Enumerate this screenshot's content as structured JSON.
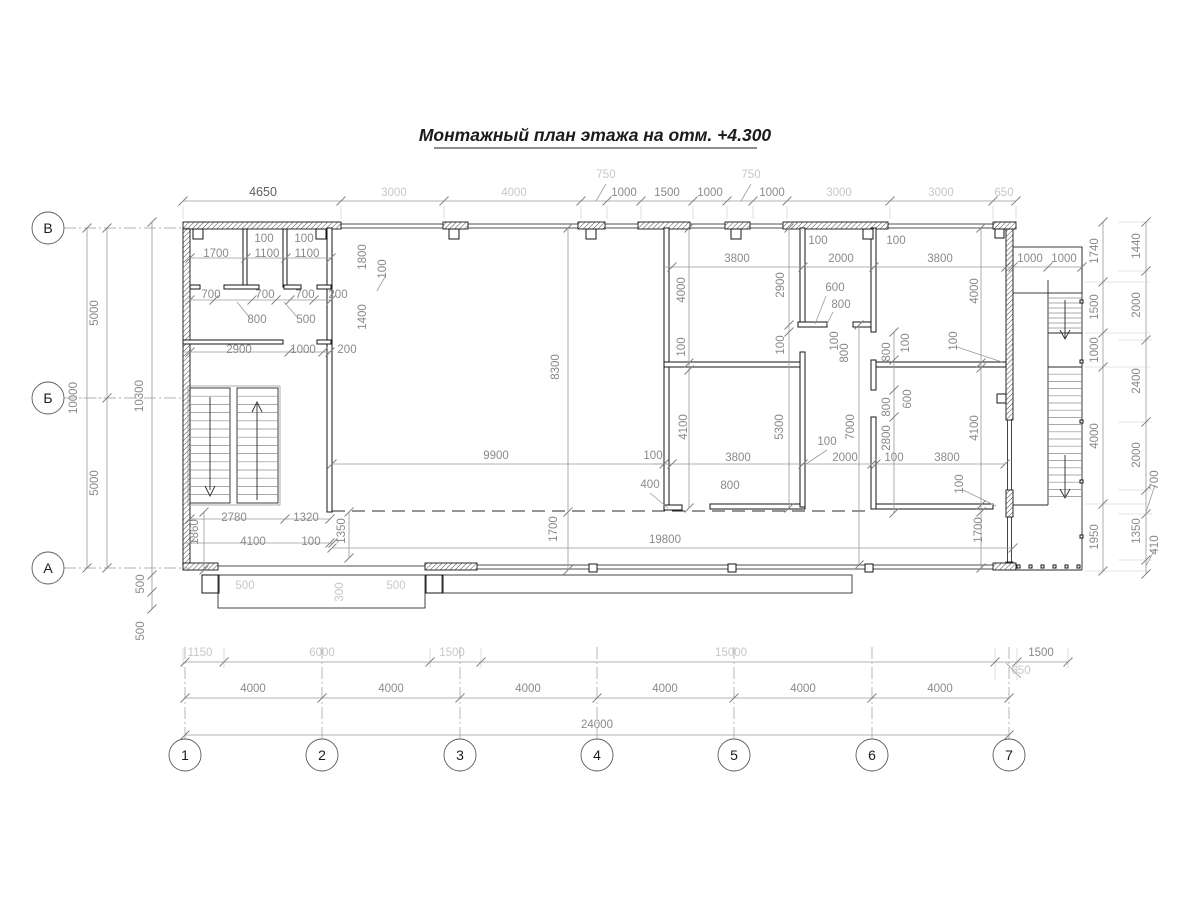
{
  "title": "Монтажный план этажа на отм. +4.300",
  "axis_bubbles": {
    "bottom": {
      "y": 755,
      "items": [
        {
          "label": "1",
          "x": 185
        },
        {
          "label": "2",
          "x": 322
        },
        {
          "label": "3",
          "x": 460
        },
        {
          "label": "4",
          "x": 597
        },
        {
          "label": "5",
          "x": 734
        },
        {
          "label": "6",
          "x": 872
        },
        {
          "label": "7",
          "x": 1009
        }
      ]
    },
    "left": {
      "x": 48,
      "items": [
        {
          "label": "В",
          "y": 228
        },
        {
          "label": "Б",
          "y": 398
        },
        {
          "label": "А",
          "y": 568
        }
      ]
    }
  },
  "colors": {
    "wall": "#161616",
    "dim_text": "#8a8a8a",
    "dim_text_light": "#c7c7c7",
    "dim_text_dark": "#606060"
  },
  "dims": [
    [
      "4650",
      263,
      196,
      0,
      "d"
    ],
    [
      "3000",
      394,
      196,
      0,
      "l"
    ],
    [
      "4000",
      514,
      196,
      0,
      "l"
    ],
    [
      "750",
      606,
      178,
      0,
      "l"
    ],
    [
      "1000",
      624,
      196,
      0,
      "n"
    ],
    [
      "1500",
      667,
      196,
      0,
      "n"
    ],
    [
      "1000",
      710,
      196,
      0,
      "n"
    ],
    [
      "750",
      751,
      178,
      0,
      "l"
    ],
    [
      "1000",
      772,
      196,
      0,
      "n"
    ],
    [
      "3000",
      839,
      196,
      0,
      "l"
    ],
    [
      "3000",
      941,
      196,
      0,
      "l"
    ],
    [
      "650",
      1004,
      196,
      0,
      "l"
    ],
    [
      "5000",
      98,
      313,
      1,
      "n"
    ],
    [
      "10000",
      77,
      398,
      1,
      "n"
    ],
    [
      "5000",
      98,
      483,
      1,
      "n"
    ],
    [
      "10300",
      143,
      396,
      1,
      "n"
    ],
    [
      "500",
      144,
      584,
      1,
      "n"
    ],
    [
      "500",
      144,
      631,
      1,
      "n"
    ],
    [
      "1740",
      1098,
      251,
      1,
      "n"
    ],
    [
      "1500",
      1098,
      307,
      1,
      "n"
    ],
    [
      "1000",
      1098,
      350,
      1,
      "n"
    ],
    [
      "4000",
      1098,
      436,
      1,
      "n"
    ],
    [
      "1950",
      1098,
      537,
      1,
      "n"
    ],
    [
      "1440",
      1140,
      246,
      1,
      "n"
    ],
    [
      "2000",
      1140,
      305,
      1,
      "n"
    ],
    [
      "2400",
      1140,
      381,
      1,
      "n"
    ],
    [
      "2000",
      1140,
      455,
      1,
      "n"
    ],
    [
      "700",
      1158,
      480,
      1,
      "n"
    ],
    [
      "1350",
      1140,
      531,
      1,
      "n"
    ],
    [
      "410",
      1158,
      545,
      1,
      "n"
    ],
    [
      "1150",
      200,
      656,
      0,
      "l"
    ],
    [
      "6000",
      322,
      656,
      0,
      "l"
    ],
    [
      "1500",
      452,
      656,
      0,
      "l"
    ],
    [
      "15000",
      731,
      656,
      0,
      "l"
    ],
    [
      "1500",
      1041,
      656,
      0,
      "n"
    ],
    [
      "650",
      1021,
      674,
      0,
      "l"
    ],
    [
      "4000",
      253,
      692,
      0,
      "n"
    ],
    [
      "4000",
      391,
      692,
      0,
      "n"
    ],
    [
      "4000",
      528,
      692,
      0,
      "n"
    ],
    [
      "4000",
      665,
      692,
      0,
      "n"
    ],
    [
      "4000",
      803,
      692,
      0,
      "n"
    ],
    [
      "4000",
      940,
      692,
      0,
      "n"
    ],
    [
      "24000",
      597,
      728,
      0,
      "n"
    ],
    [
      "1700",
      216,
      257,
      0,
      "n"
    ],
    [
      "100",
      264,
      242,
      0,
      "n"
    ],
    [
      "1100",
      267,
      257,
      0,
      "n"
    ],
    [
      "100",
      304,
      242,
      0,
      "n"
    ],
    [
      "1100",
      307,
      257,
      0,
      "n"
    ],
    [
      "700",
      211,
      298,
      0,
      "n"
    ],
    [
      "700",
      265,
      298,
      0,
      "n"
    ],
    [
      "700",
      305,
      298,
      0,
      "n"
    ],
    [
      "200",
      338,
      298,
      0,
      "n"
    ],
    [
      "800",
      257,
      323,
      0,
      "n"
    ],
    [
      "500",
      306,
      323,
      0,
      "n"
    ],
    [
      "1800",
      366,
      257,
      1,
      "n"
    ],
    [
      "100",
      386,
      269,
      1,
      "n"
    ],
    [
      "1400",
      366,
      317,
      1,
      "n"
    ],
    [
      "2900",
      239,
      353,
      0,
      "n"
    ],
    [
      "1000",
      303,
      353,
      0,
      "n"
    ],
    [
      "200",
      347,
      353,
      0,
      "n"
    ],
    [
      "2780",
      234,
      521,
      0,
      "n"
    ],
    [
      "1320",
      306,
      521,
      0,
      "n"
    ],
    [
      "4100",
      253,
      545,
      0,
      "n"
    ],
    [
      "100",
      311,
      545,
      0,
      "n"
    ],
    [
      "1860",
      198,
      532,
      1,
      "n"
    ],
    [
      "1350",
      345,
      531,
      1,
      "n"
    ],
    [
      "500",
      245,
      589,
      0,
      "l"
    ],
    [
      "300",
      343,
      592,
      1,
      "l"
    ],
    [
      "500",
      396,
      589,
      0,
      "l"
    ],
    [
      "8300",
      559,
      367,
      1,
      "n"
    ],
    [
      "9900",
      496,
      459,
      0,
      "n"
    ],
    [
      "1700",
      557,
      529,
      1,
      "n"
    ],
    [
      "19800",
      665,
      543,
      0,
      "n"
    ],
    [
      "100",
      653,
      459,
      0,
      "n"
    ],
    [
      "400",
      650,
      488,
      0,
      "n"
    ],
    [
      "800",
      730,
      489,
      0,
      "n"
    ],
    [
      "3800",
      737,
      262,
      0,
      "n"
    ],
    [
      "2000",
      841,
      262,
      0,
      "n"
    ],
    [
      "3800",
      940,
      262,
      0,
      "n"
    ],
    [
      "1000",
      1030,
      262,
      0,
      "n"
    ],
    [
      "1000",
      1064,
      262,
      0,
      "n"
    ],
    [
      "100",
      818,
      244,
      0,
      "n"
    ],
    [
      "100",
      896,
      244,
      0,
      "n"
    ],
    [
      "4000",
      685,
      290,
      1,
      "n"
    ],
    [
      "100",
      685,
      347,
      1,
      "n"
    ],
    [
      "4100",
      687,
      427,
      1,
      "n"
    ],
    [
      "2900",
      784,
      285,
      1,
      "n"
    ],
    [
      "100",
      784,
      345,
      1,
      "n"
    ],
    [
      "5300",
      783,
      427,
      1,
      "n"
    ],
    [
      "7000",
      854,
      427,
      1,
      "n"
    ],
    [
      "600",
      835,
      291,
      0,
      "n"
    ],
    [
      "800",
      841,
      308,
      0,
      "n"
    ],
    [
      "800",
      848,
      353,
      1,
      "n"
    ],
    [
      "100",
      838,
      341,
      1,
      "n"
    ],
    [
      "800",
      890,
      352,
      1,
      "n"
    ],
    [
      "100",
      909,
      343,
      1,
      "n"
    ],
    [
      "800",
      890,
      407,
      1,
      "n"
    ],
    [
      "600",
      911,
      399,
      1,
      "n"
    ],
    [
      "2800",
      890,
      438,
      1,
      "n"
    ],
    [
      "100",
      957,
      341,
      1,
      "n"
    ],
    [
      "100",
      963,
      484,
      1,
      "n"
    ],
    [
      "100",
      827,
      445,
      0,
      "n"
    ],
    [
      "3800",
      738,
      461,
      0,
      "n"
    ],
    [
      "2000",
      845,
      461,
      0,
      "n"
    ],
    [
      "100",
      894,
      461,
      0,
      "n"
    ],
    [
      "3800",
      947,
      461,
      0,
      "n"
    ],
    [
      "4000",
      978,
      291,
      1,
      "n"
    ],
    [
      "4100",
      978,
      428,
      1,
      "n"
    ],
    [
      "1700",
      982,
      530,
      1,
      "n"
    ]
  ]
}
